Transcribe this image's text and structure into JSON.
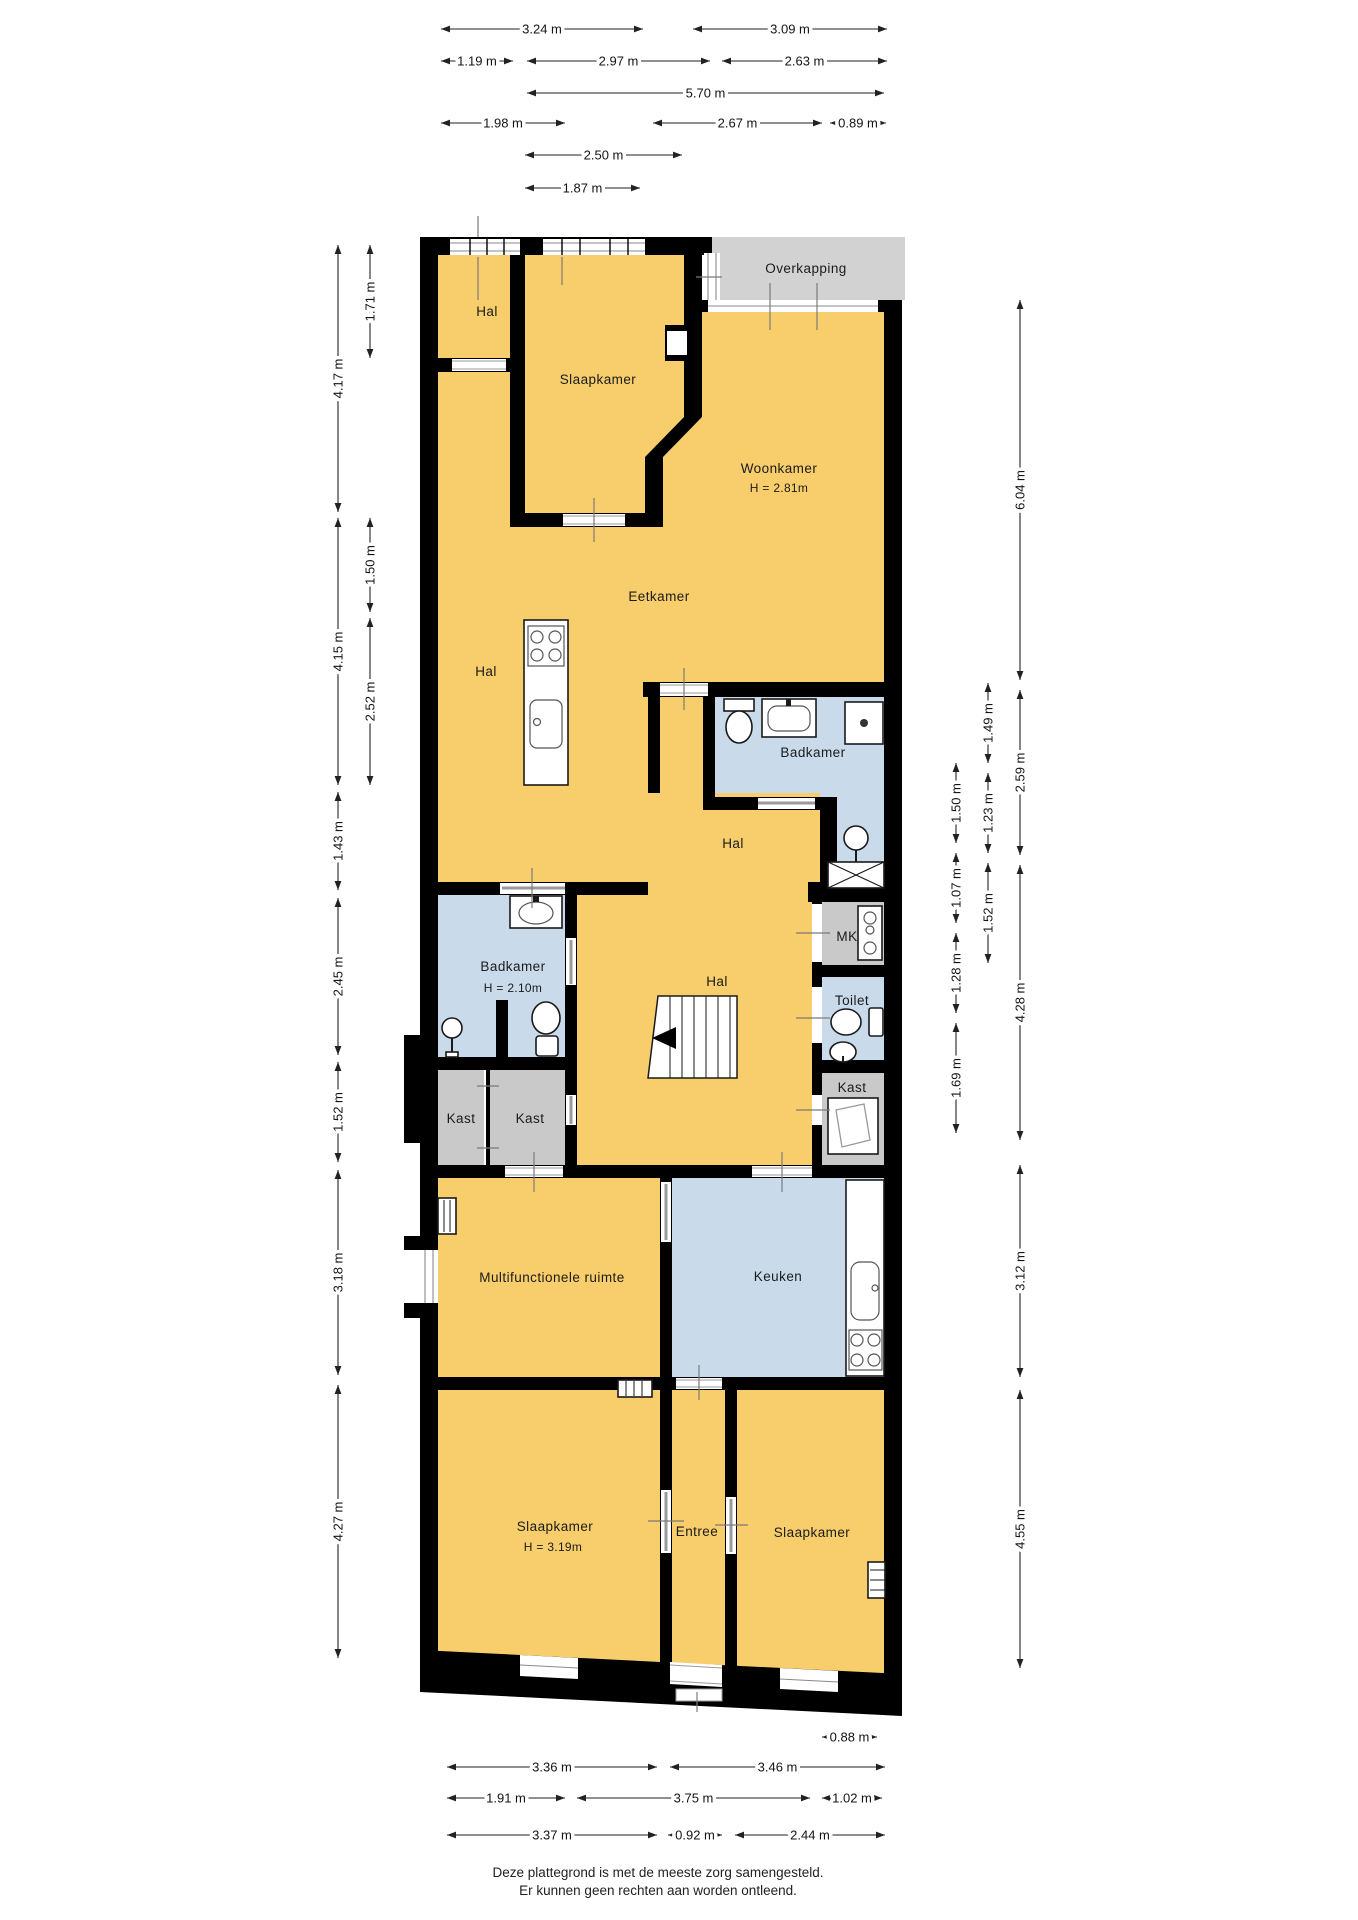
{
  "colors": {
    "room_yellow": "#F7CE6B",
    "room_blue": "#C9DBEA",
    "room_gray": "#C9C9C9",
    "overkapping_gray": "#D2D2D2",
    "wall": "#000000"
  },
  "rooms": {
    "hal_top_left": {
      "label": "Hal"
    },
    "slaapkamer_top": {
      "label": "Slaapkamer"
    },
    "overkapping": {
      "label": "Overkapping"
    },
    "woonkamer": {
      "label": "Woonkamer",
      "height": "H = 2.81m"
    },
    "eetkamer": {
      "label": "Eetkamer"
    },
    "hal_mid_left": {
      "label": "Hal"
    },
    "badkamer_boven": {
      "label": "Badkamer"
    },
    "hal_boven": {
      "label": "Hal"
    },
    "badkamer_links": {
      "label": "Badkamer",
      "height": "H = 2.10m"
    },
    "hal_centraal": {
      "label": "Hal"
    },
    "mk": {
      "label": "MK"
    },
    "toilet": {
      "label": "Toilet"
    },
    "kast_rechts": {
      "label": "Kast"
    },
    "kast_links": {
      "label": "Kast"
    },
    "kast_midden": {
      "label": "Kast"
    },
    "multifunctionele_ruimte": {
      "label": "Multifunctionele ruimte"
    },
    "keuken": {
      "label": "Keuken"
    },
    "slaapkamer_linksonder": {
      "label": "Slaapkamer",
      "height": "H = 3.19m"
    },
    "entree": {
      "label": "Entree"
    },
    "slaapkamer_rechtsonder": {
      "label": "Slaapkamer"
    }
  },
  "dimensions": {
    "horizontal": [
      {
        "label": "3.24 m",
        "y": 29,
        "x1": 441,
        "x2": 643
      },
      {
        "label": "3.09 m",
        "y": 29,
        "x1": 693,
        "x2": 887
      },
      {
        "label": "1.19 m",
        "y": 61,
        "x1": 441,
        "x2": 513
      },
      {
        "label": "2.97 m",
        "y": 61,
        "x1": 527,
        "x2": 710
      },
      {
        "label": "2.63 m",
        "y": 61,
        "x1": 722,
        "x2": 887
      },
      {
        "label": "5.70 m",
        "y": 93,
        "x1": 527,
        "x2": 884
      },
      {
        "label": "1.98 m",
        "y": 123,
        "x1": 441,
        "x2": 565
      },
      {
        "label": "2.67 m",
        "y": 123,
        "x1": 653,
        "x2": 822
      },
      {
        "label": "0.89 m",
        "y": 123,
        "x1": 830,
        "x2": 886
      },
      {
        "label": "2.50 m",
        "y": 155,
        "x1": 525,
        "x2": 682
      },
      {
        "label": "1.87 m",
        "y": 188,
        "x1": 525,
        "x2": 640
      },
      {
        "label": "0.88 m",
        "y": 1737,
        "x1": 822,
        "x2": 877
      },
      {
        "label": "3.36 m",
        "y": 1767,
        "x1": 447,
        "x2": 657
      },
      {
        "label": "3.46 m",
        "y": 1767,
        "x1": 670,
        "x2": 885
      },
      {
        "label": "1.91 m",
        "y": 1798,
        "x1": 447,
        "x2": 565
      },
      {
        "label": "3.75 m",
        "y": 1798,
        "x1": 577,
        "x2": 810
      },
      {
        "label": "1.02 m",
        "y": 1798,
        "x1": 822,
        "x2": 882
      },
      {
        "label": "3.37 m",
        "y": 1835,
        "x1": 447,
        "x2": 657
      },
      {
        "label": "0.92 m",
        "y": 1835,
        "x1": 668,
        "x2": 722
      },
      {
        "label": "2.44 m",
        "y": 1835,
        "x1": 735,
        "x2": 885
      }
    ],
    "vertical": [
      {
        "label": "4.17 m",
        "x": 338,
        "y1": 245,
        "y2": 512
      },
      {
        "label": "4.15 m",
        "x": 338,
        "y1": 518,
        "y2": 785
      },
      {
        "label": "1.43 m",
        "x": 338,
        "y1": 792,
        "y2": 890
      },
      {
        "label": "2.45 m",
        "x": 338,
        "y1": 898,
        "y2": 1055
      },
      {
        "label": "1.52 m",
        "x": 338,
        "y1": 1062,
        "y2": 1162
      },
      {
        "label": "3.18 m",
        "x": 338,
        "y1": 1170,
        "y2": 1375
      },
      {
        "label": "4.27 m",
        "x": 338,
        "y1": 1385,
        "y2": 1658
      },
      {
        "label": "1.71 m",
        "x": 370,
        "y1": 245,
        "y2": 358
      },
      {
        "label": "1.50 m",
        "x": 370,
        "y1": 518,
        "y2": 612
      },
      {
        "label": "2.52 m",
        "x": 370,
        "y1": 618,
        "y2": 785
      },
      {
        "label": "1.50 m",
        "x": 956,
        "y1": 763,
        "y2": 843
      },
      {
        "label": "1.07 m",
        "x": 956,
        "y1": 853,
        "y2": 923
      },
      {
        "label": "1.28 m",
        "x": 956,
        "y1": 933,
        "y2": 1013
      },
      {
        "label": "1.69 m",
        "x": 956,
        "y1": 1023,
        "y2": 1133
      },
      {
        "label": "1.49 m",
        "x": 988,
        "y1": 683,
        "y2": 763
      },
      {
        "label": "1.23 m",
        "x": 988,
        "y1": 773,
        "y2": 853
      },
      {
        "label": "1.52 m",
        "x": 988,
        "y1": 863,
        "y2": 963
      },
      {
        "label": "6.04 m",
        "x": 1020,
        "y1": 300,
        "y2": 680
      },
      {
        "label": "2.59 m",
        "x": 1020,
        "y1": 690,
        "y2": 855
      },
      {
        "label": "4.28 m",
        "x": 1020,
        "y1": 865,
        "y2": 1140
      },
      {
        "label": "3.12 m",
        "x": 1020,
        "y1": 1165,
        "y2": 1377
      },
      {
        "label": "4.55 m",
        "x": 1020,
        "y1": 1390,
        "y2": 1668
      }
    ]
  },
  "footer": {
    "line1": "Deze plattegrond is met de meeste zorg samengesteld.",
    "line2": "Er kunnen geen rechten aan worden ontleend."
  }
}
